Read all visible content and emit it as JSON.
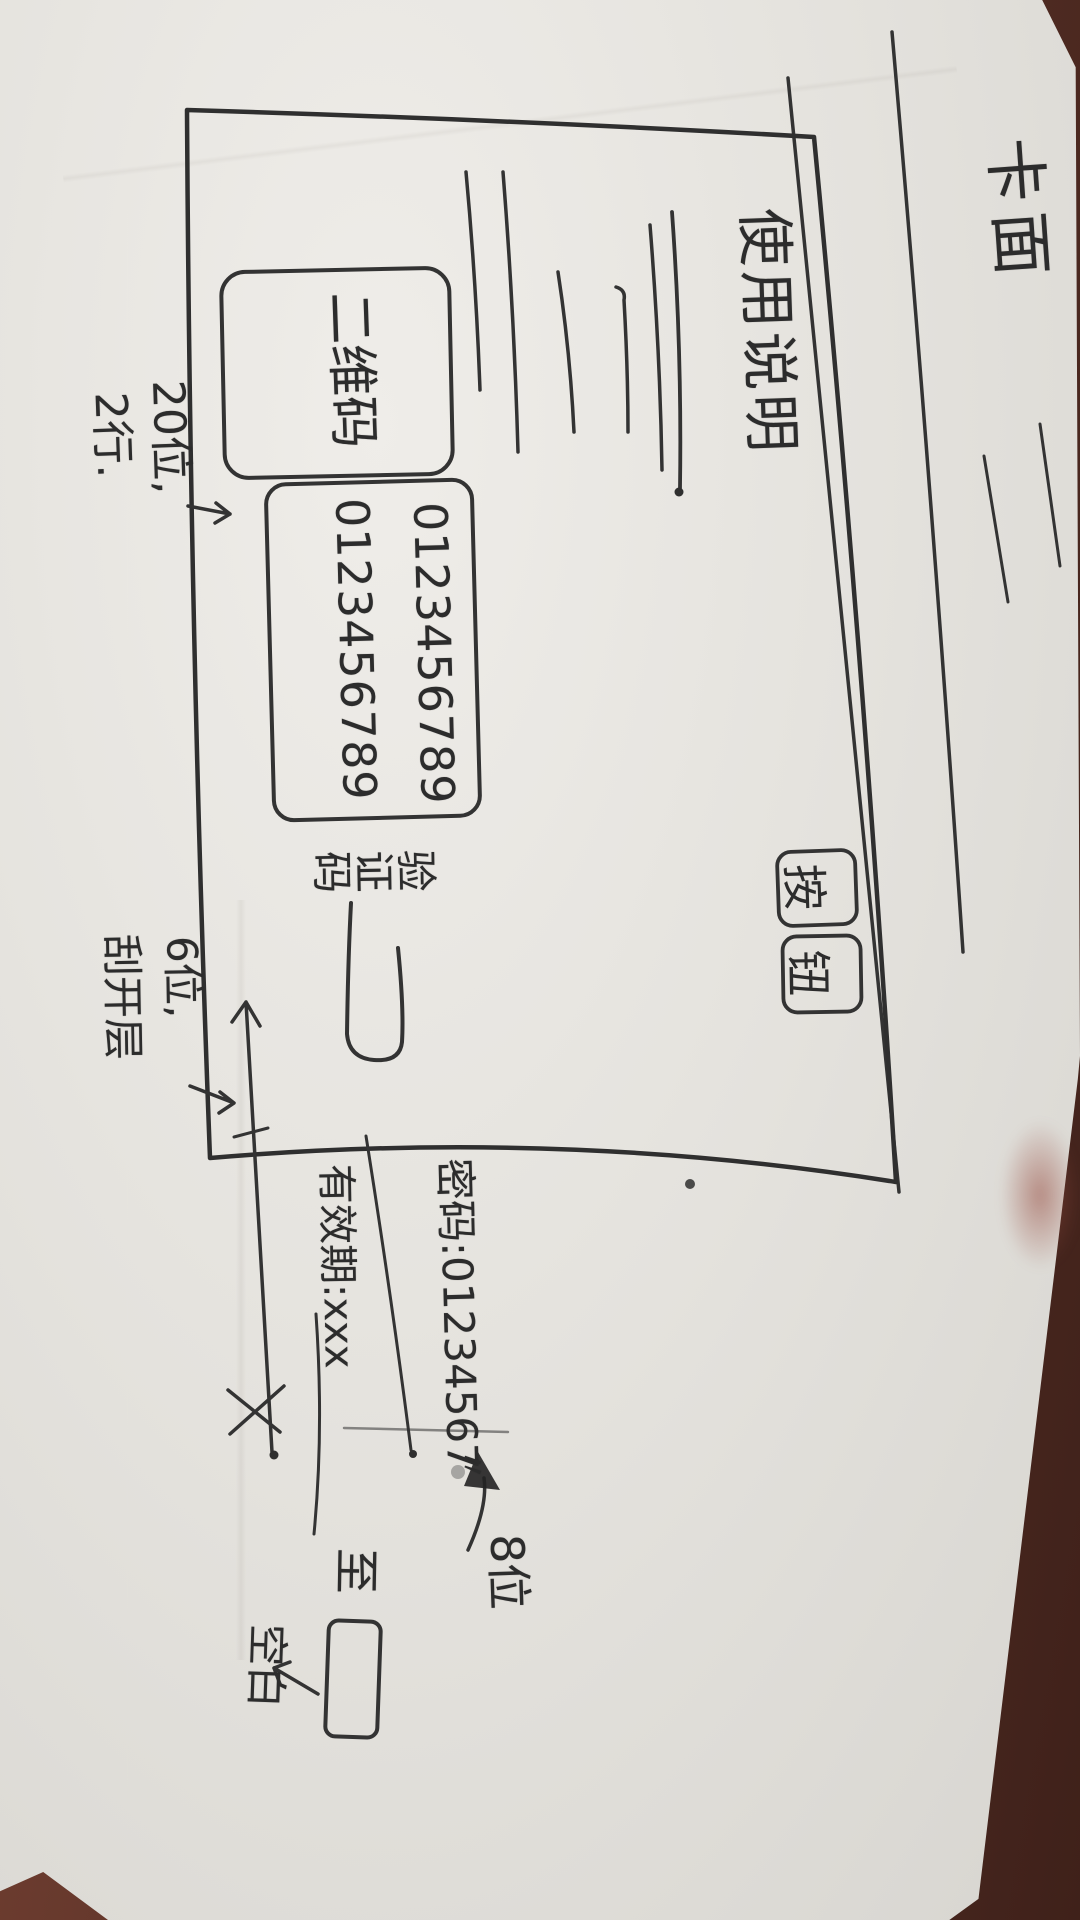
{
  "photo": {
    "paper_color": "#e6e4df",
    "ink_color": "#2e2e2e",
    "desk_color": "#5d3329"
  },
  "sketch": {
    "page_title": "卡面",
    "dialog": {
      "heading": "使用说明",
      "qr_label": "二维码",
      "digit_row_1": "0123456789",
      "digit_row_2": "0123456789",
      "code_label": "验证码",
      "button_1": "按",
      "button_2": "钮"
    },
    "annotations": {
      "rows_note_1": "20位,",
      "rows_note_2": "2行.",
      "code_note_1": "6位,",
      "code_note_2": "刮开层",
      "password_example": "密码:01234567",
      "ditto_mark": "〃",
      "validity": "有效期:xxx",
      "to_label": "至",
      "blank_label": "空白",
      "length_note": "8位"
    }
  }
}
